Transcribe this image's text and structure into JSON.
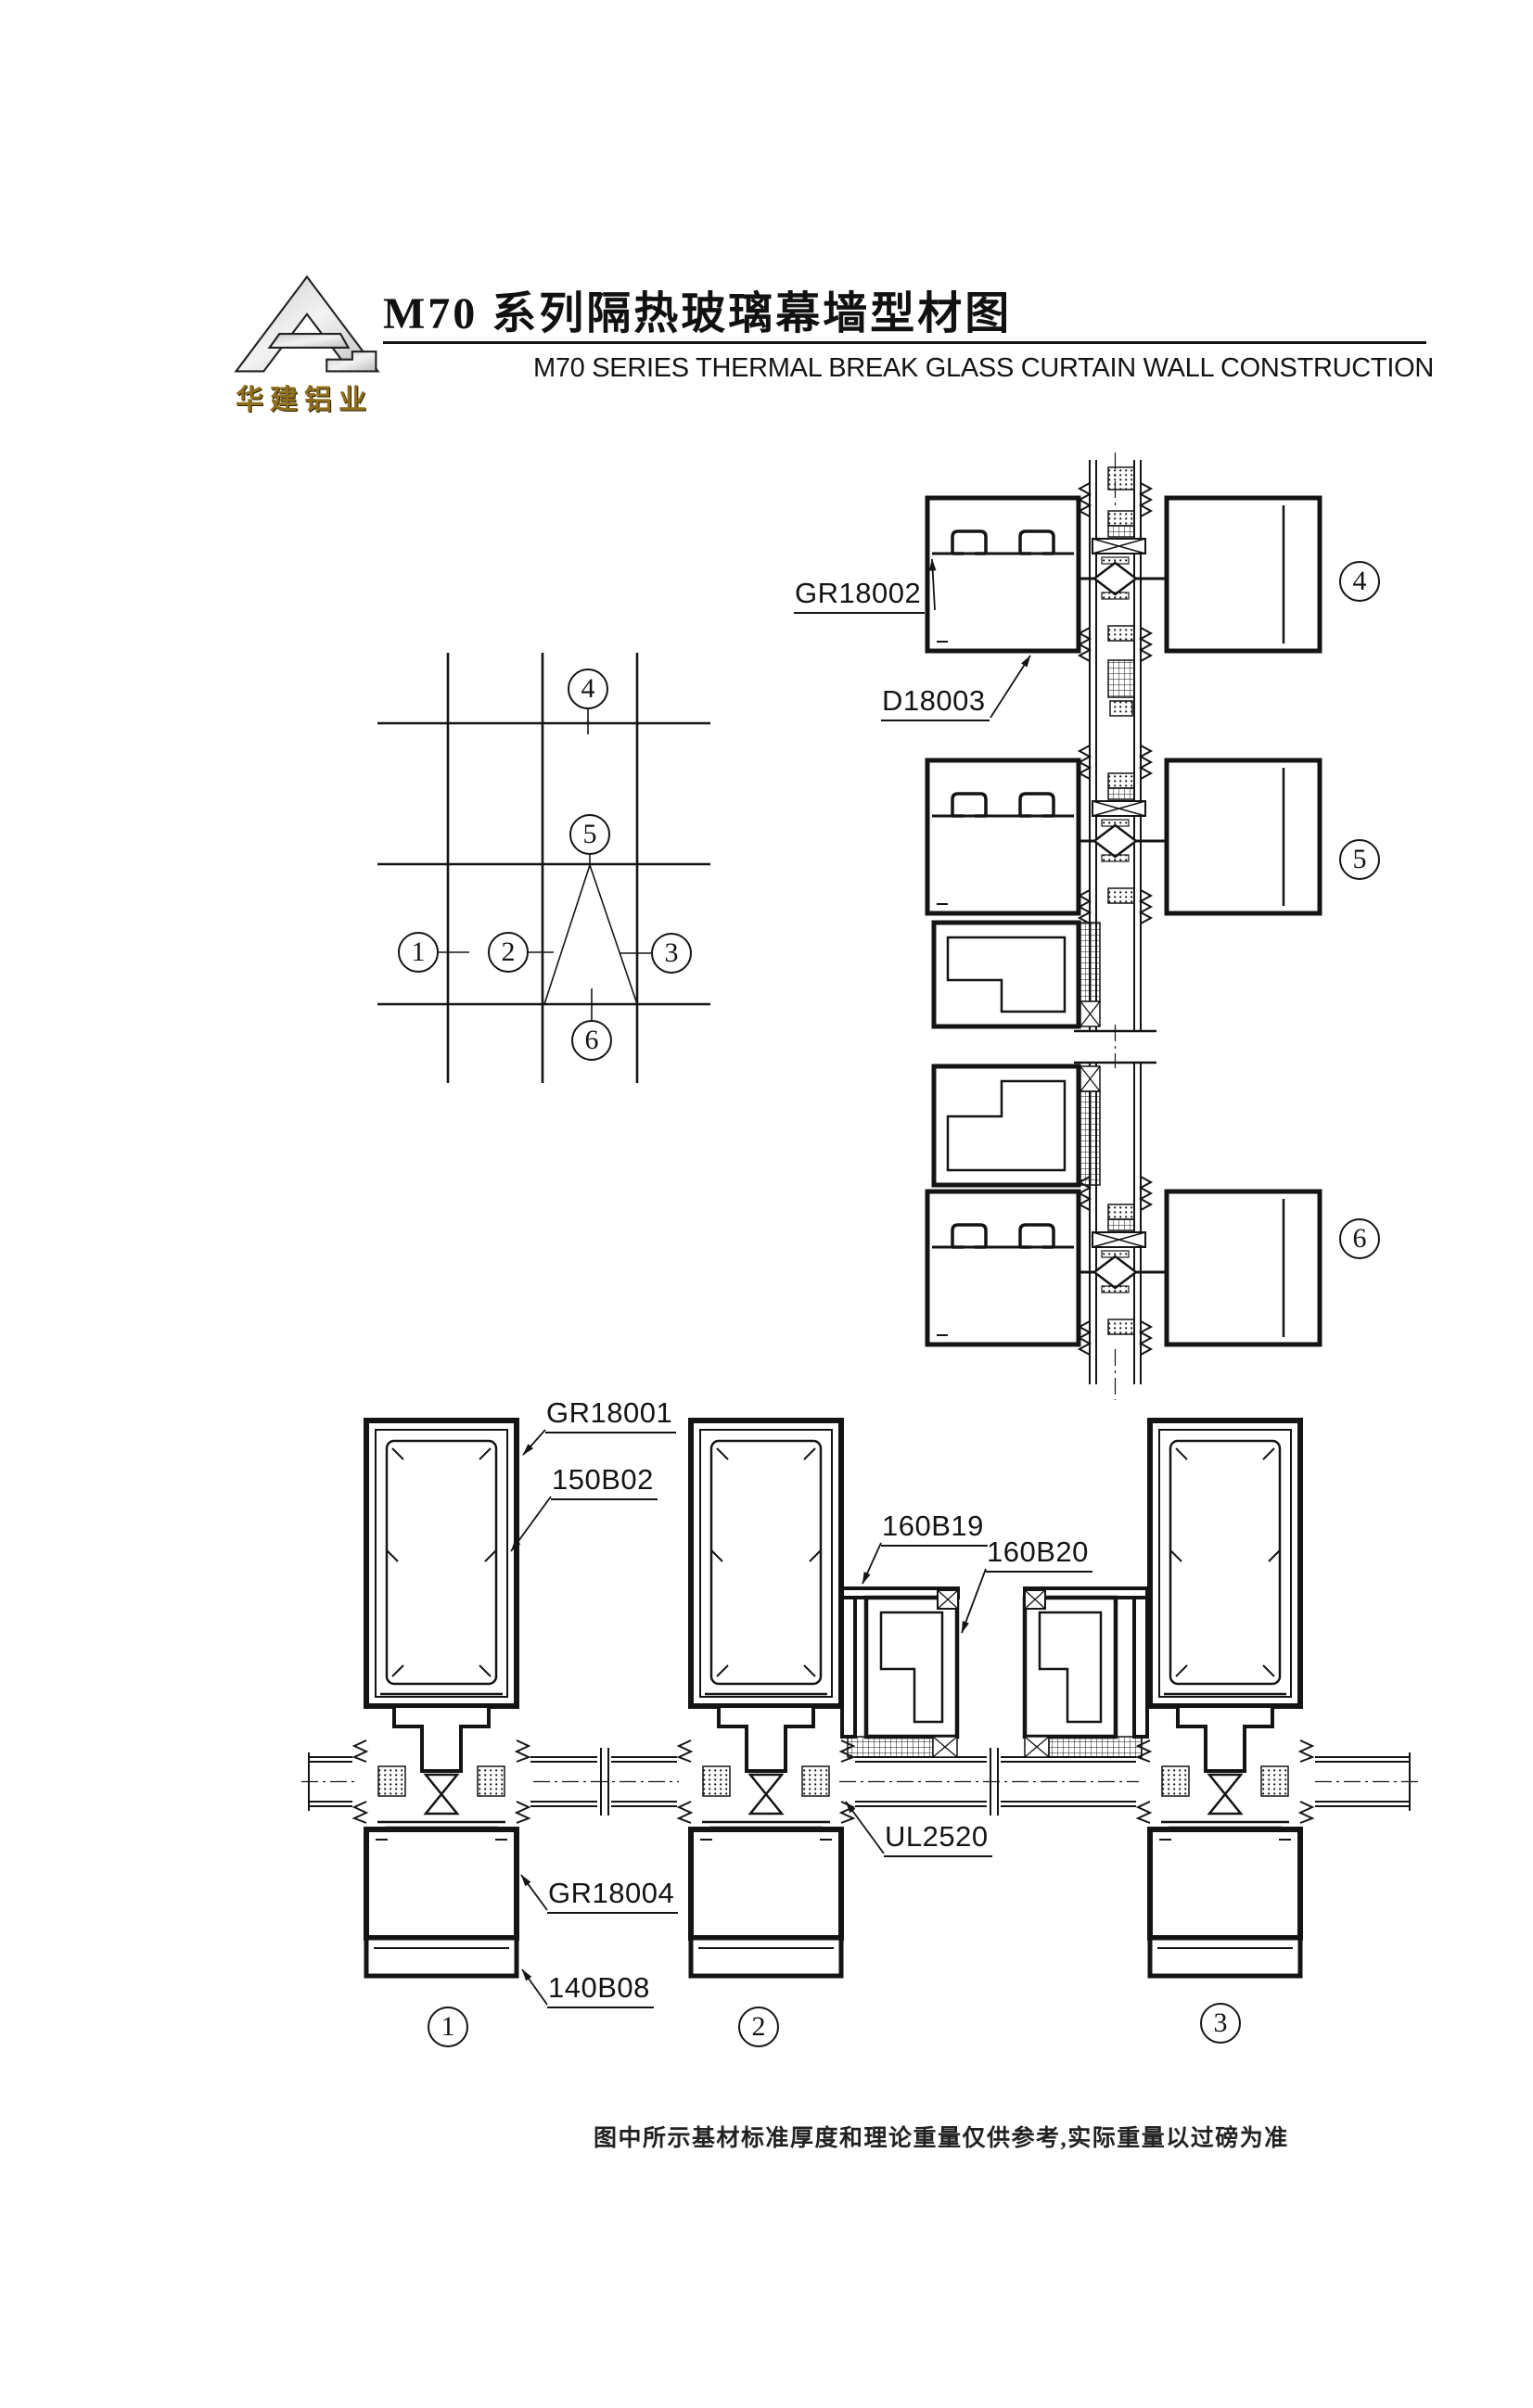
{
  "header": {
    "logo_text": "华建铝业",
    "title_cn": "M70 系列隔热玻璃幕墙型材图",
    "title_en": "M70  SERIES THERMAL BREAK GLASS CURTAIN WALL CONSTRUCTION"
  },
  "labels": {
    "gr18001": "GR18001",
    "gr18002": "GR18002",
    "gr18004": "GR18004",
    "d18003": "D18003",
    "b150": "150B02",
    "b160a": "160B19",
    "b160b": "160B20",
    "ul": "UL2520",
    "b140": "140B08"
  },
  "markers": {
    "m1": "1",
    "m2": "2",
    "m3": "3",
    "m4": "4",
    "m5": "5",
    "m6": "6"
  },
  "footer": {
    "note": "图中所示基材标准厚度和理论重量仅供参考,实际重量以过磅为准"
  },
  "colors": {
    "ink": "#141414",
    "logo_gold": "#8f6f1d"
  }
}
